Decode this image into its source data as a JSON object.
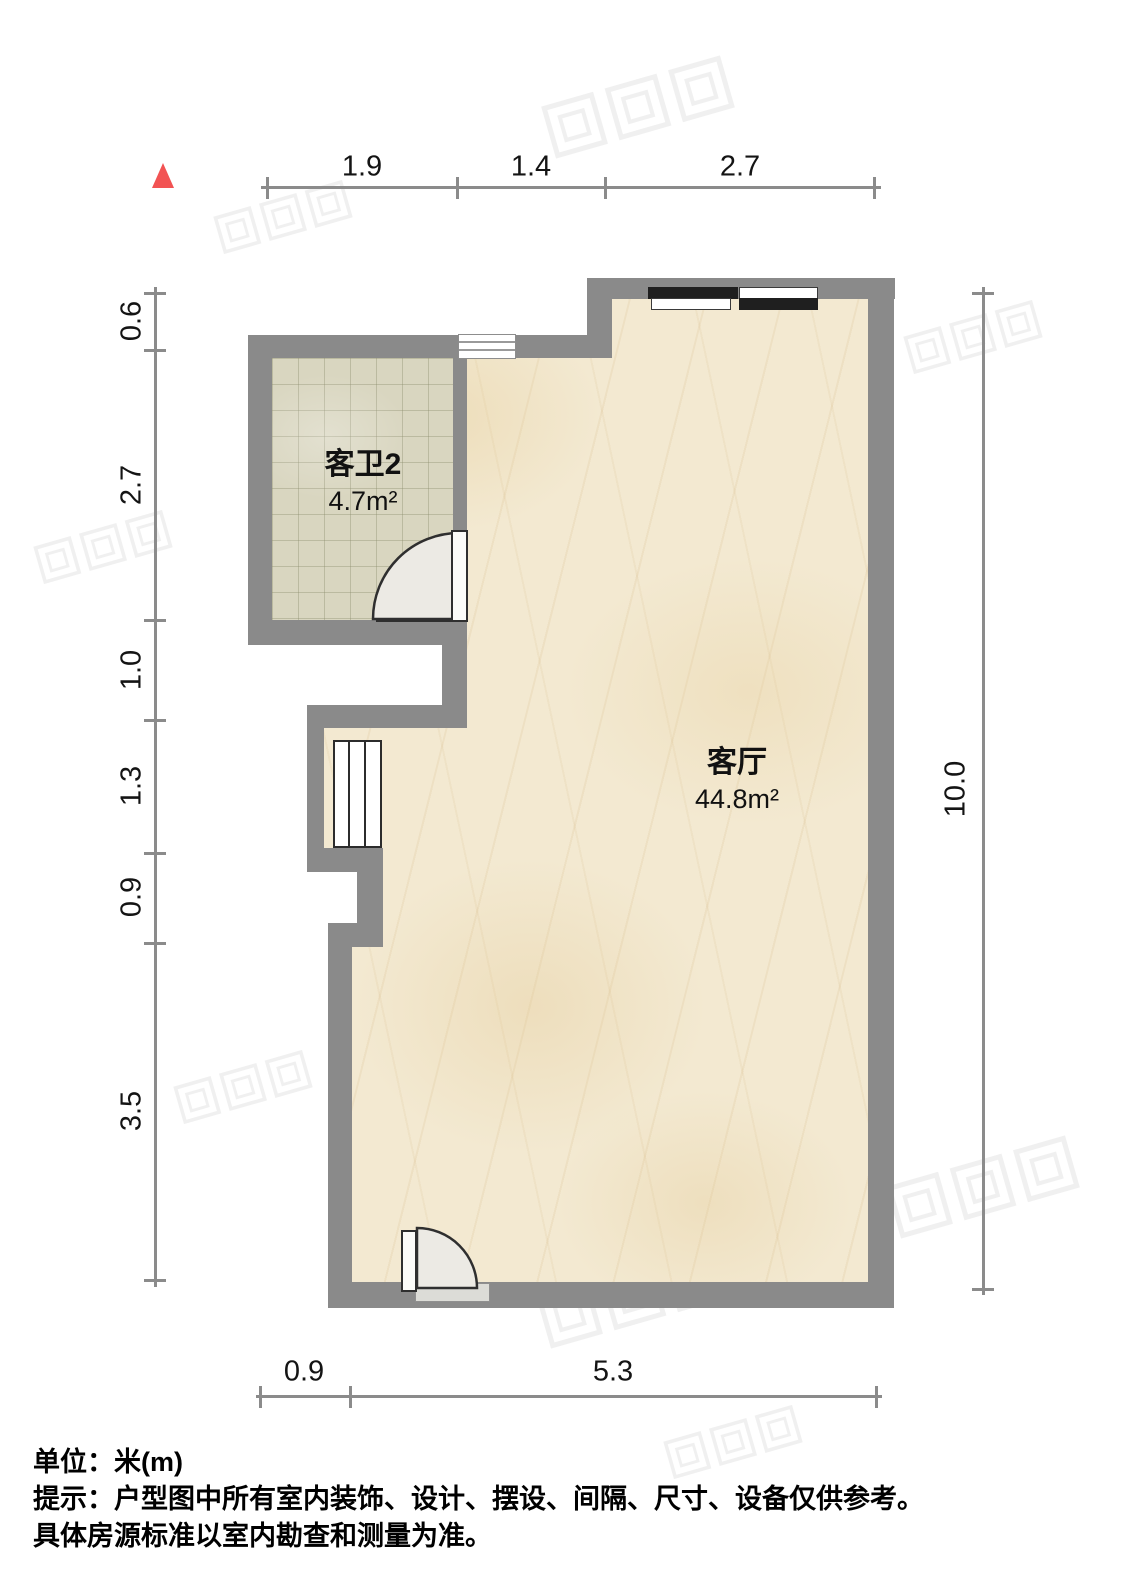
{
  "rooms": {
    "bathroom": {
      "name": "客卫2",
      "area": "4.7m²"
    },
    "living": {
      "name": "客厅",
      "area": "44.8m²"
    }
  },
  "dimensions": {
    "top": {
      "d1": "1.9",
      "d2": "1.4",
      "d3": "2.7"
    },
    "left": {
      "d1": "0.6",
      "d2": "2.7",
      "d3": "1.0",
      "d4": "1.3",
      "d5": "0.9",
      "d6": "3.5"
    },
    "right": {
      "d1": "10.0"
    },
    "bottom": {
      "d1": "0.9",
      "d2": "5.3"
    }
  },
  "footer": {
    "line1": "单位：米(m)",
    "line2": "提示：户型图中所有室内装饰、设计、摆设、间隔、尺寸、设备仅供参考。",
    "line3": "具体房源标准以室内勘查和测量为准。"
  },
  "colors": {
    "wall": "#8a8a8a",
    "living_floor": "#f3e9d1",
    "bathroom_floor": "#d9d6c0",
    "dimension_line": "#8b8b8b",
    "north_marker": "#f25353",
    "window_bar_dark": "#1f1f1f"
  }
}
